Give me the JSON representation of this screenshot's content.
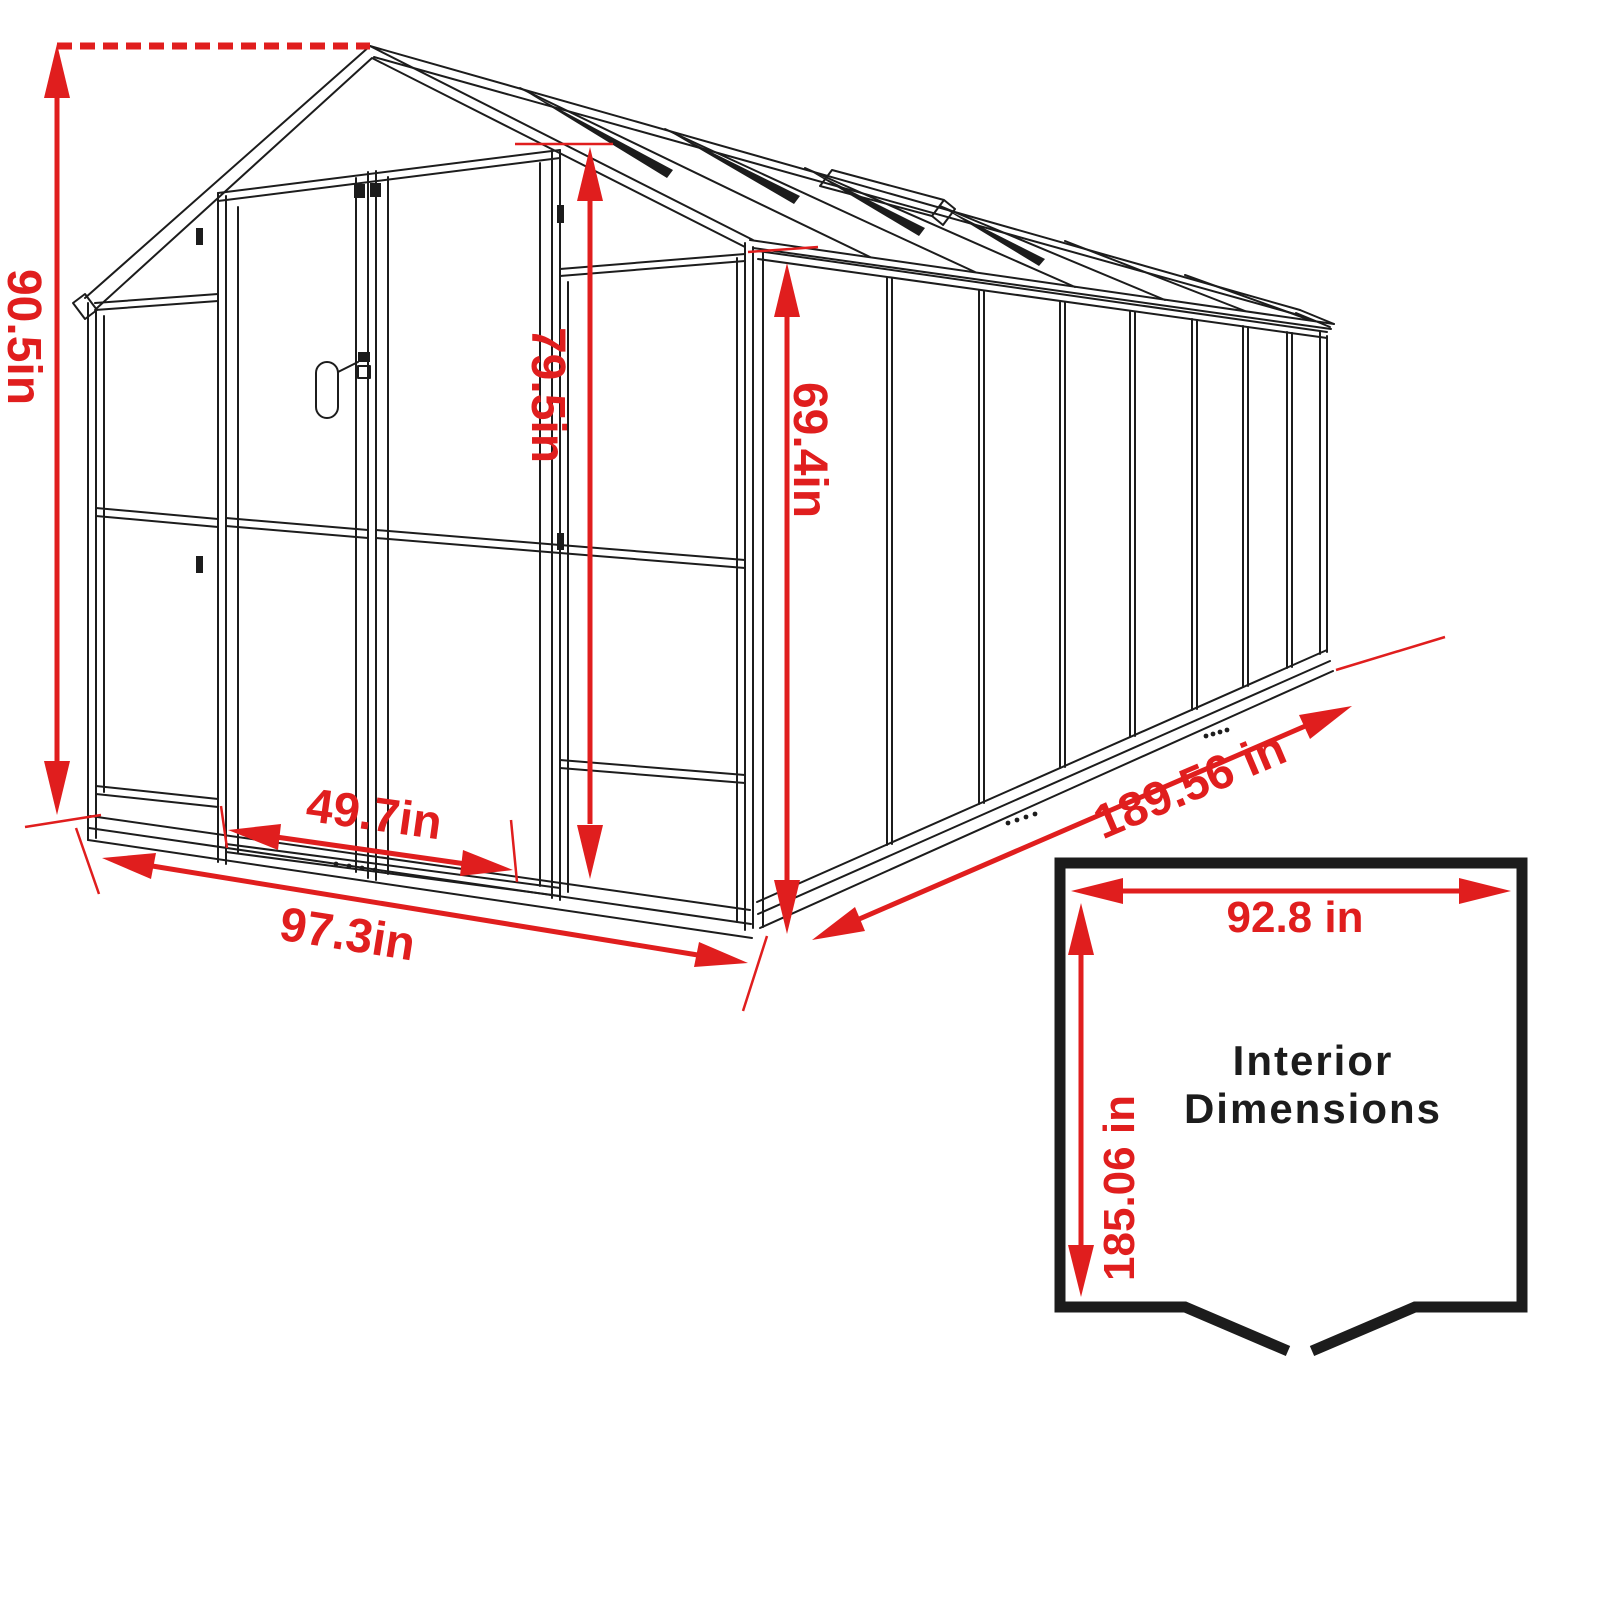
{
  "colors": {
    "accent": "#e01e1e",
    "ink": "#1c1c1c",
    "paper": "#ffffff"
  },
  "diagram": {
    "type": "greenhouse-dimension-drawing",
    "dimensions": {
      "overall_height": "90.5in",
      "door_height": "79.5in",
      "wall_height": "69.4in",
      "door_width": "49.7in",
      "front_width": "97.3in",
      "side_length": "189.56 in"
    },
    "interior": {
      "heading_line1": "Interior",
      "heading_line2": "Dimensions",
      "width": "92.8 in",
      "depth": "185.06 in"
    }
  }
}
